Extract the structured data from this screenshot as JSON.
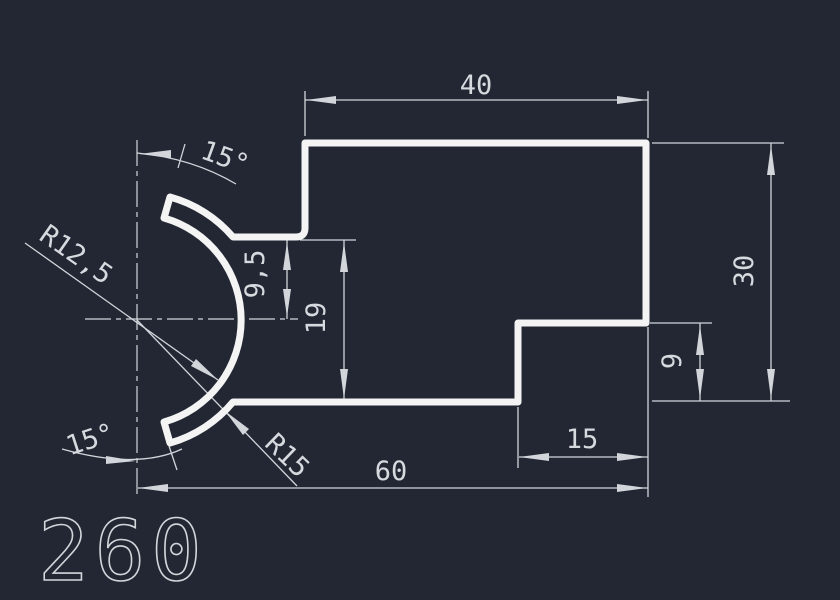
{
  "colors": {
    "background": "#222733",
    "outline": "#f4f4f4",
    "dimension_lines": "#d2d5da",
    "dimension_text": "#d6d9de"
  },
  "part": {
    "number": "260"
  },
  "dimensions": {
    "top_width": "40",
    "right_height": "30",
    "step_height": "9",
    "step_width": "15",
    "total_width": "60",
    "notch_height": "19",
    "ledge_offset": "9,5",
    "inner_radius": "R12,5",
    "outer_radius": "R15",
    "upper_angle": "15°",
    "lower_angle": "15°"
  }
}
